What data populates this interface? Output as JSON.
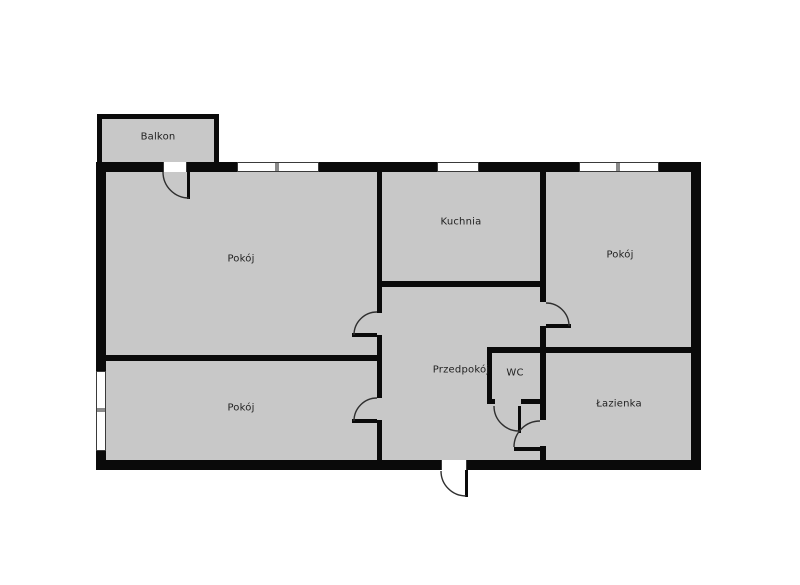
{
  "title": "Apartment floor plan",
  "colors": {
    "wall": "#0a0a0a",
    "floor": "#c8c8c8",
    "background": "#ffffff",
    "door_arc": "#2f2f2f",
    "window_frame": "#3a3a3a",
    "label": "#1f1f1f"
  },
  "rooms": [
    {
      "id": "balkon",
      "label": "Balkon"
    },
    {
      "id": "pokoj-top-left",
      "label": "Pokój"
    },
    {
      "id": "kuchnia",
      "label": "Kuchnia"
    },
    {
      "id": "pokoj-right",
      "label": "Pokój"
    },
    {
      "id": "pokoj-bottom-left",
      "label": "Pokój"
    },
    {
      "id": "przedpokoj",
      "label": "Przedpokój"
    },
    {
      "id": "wc",
      "label": "WC"
    },
    {
      "id": "lazienka",
      "label": "Łazienka"
    }
  ]
}
